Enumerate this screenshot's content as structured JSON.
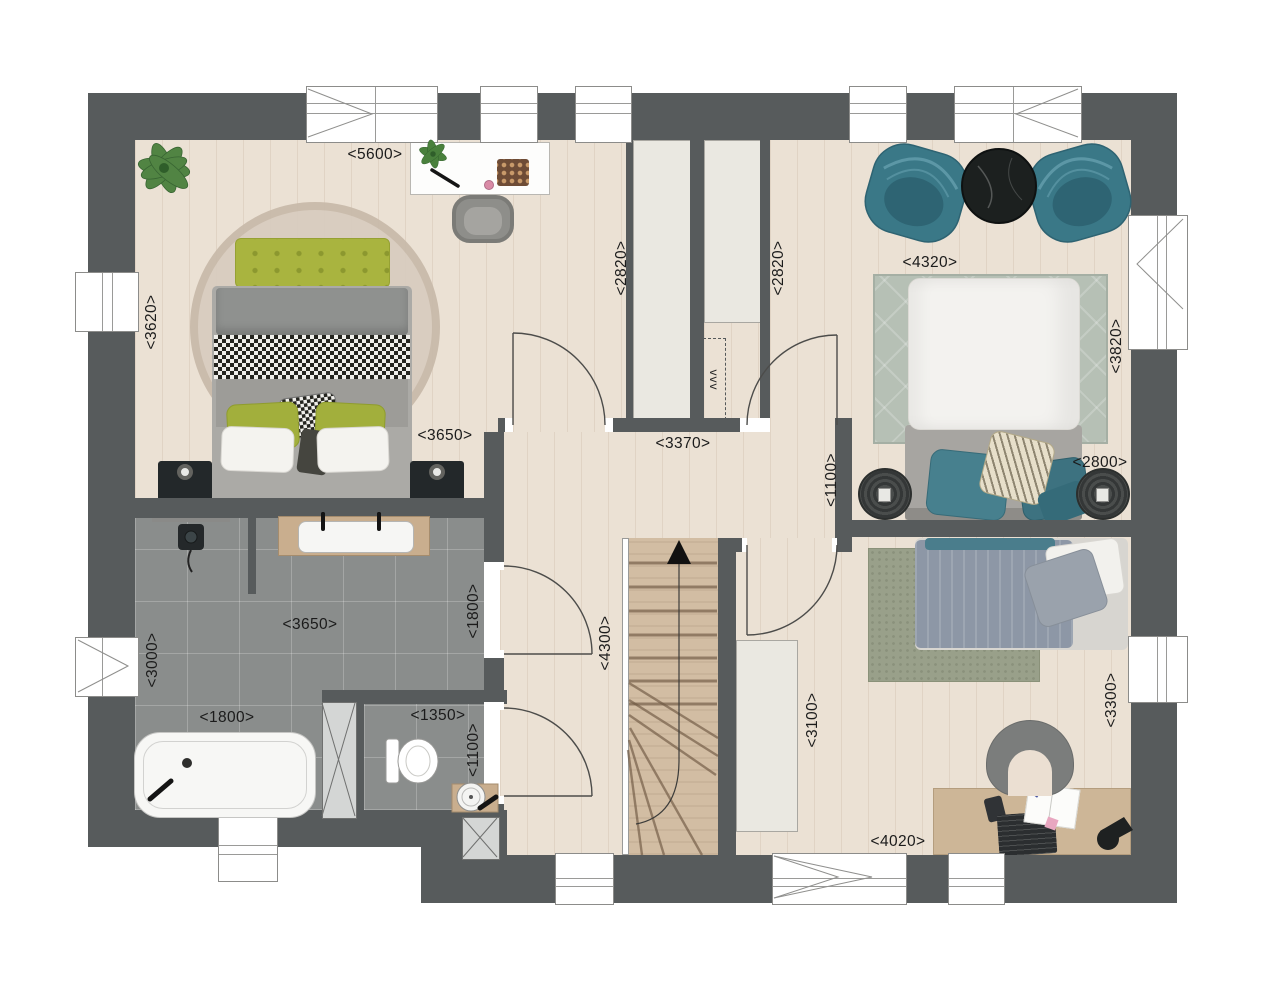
{
  "plan": {
    "type": "first-floor-architectural-plan",
    "vent_label": "vvv",
    "colors": {
      "wall": "#575b5c",
      "wood_floor": "#ebe1d4",
      "tile_floor": "#8a8d8c",
      "closet": "#eae8e1",
      "stairs": "#d2bda3",
      "accent_teal": "#3a7887",
      "accent_green": "#a8b33e",
      "rug_sage": "#b6c0b5",
      "dimension_text": "#1b1b1b"
    }
  },
  "dimensions": {
    "master_width": "<5600>",
    "master_height": "<3620>",
    "master_lower": "<3650>",
    "closet_left": "<2820>",
    "closet_right": "<2820>",
    "bed2_width": "<4320>",
    "bed2_height": "<3820>",
    "bed2_lower": "<2800>",
    "hall_wall": "<1100>",
    "hall_width": "<3370>",
    "hall_height": "<4300>",
    "bath_width": "<3650>",
    "bath_height": "<3000>",
    "bath_east": "<1800>",
    "tub_width": "<1800>",
    "wc_width": "<1350>",
    "wc_height": "<1100>",
    "bed3_west": "<3100>",
    "bed3_east": "<3300>",
    "bed3_width": "<4020>"
  },
  "furniture": {
    "master_bedroom": [
      "double-bed",
      "green-headboard",
      "round-rug",
      "nightstand",
      "nightstand",
      "dressing-table",
      "stool",
      "plant"
    ],
    "bedroom_2": [
      "armchair",
      "armchair",
      "round-coffee-table",
      "double-bed",
      "area-rug",
      "pouf",
      "pouf"
    ],
    "bedroom_3": [
      "single-bed",
      "area-rug",
      "desk",
      "desk-chair",
      "laptop",
      "notebook",
      "desk-lamp",
      "wardrobe"
    ],
    "bathroom": [
      "bathtub",
      "double-vanity",
      "shower",
      "duct"
    ],
    "wc": [
      "toilet",
      "corner-sink",
      "duct"
    ],
    "hall": [
      "staircase-up"
    ]
  }
}
